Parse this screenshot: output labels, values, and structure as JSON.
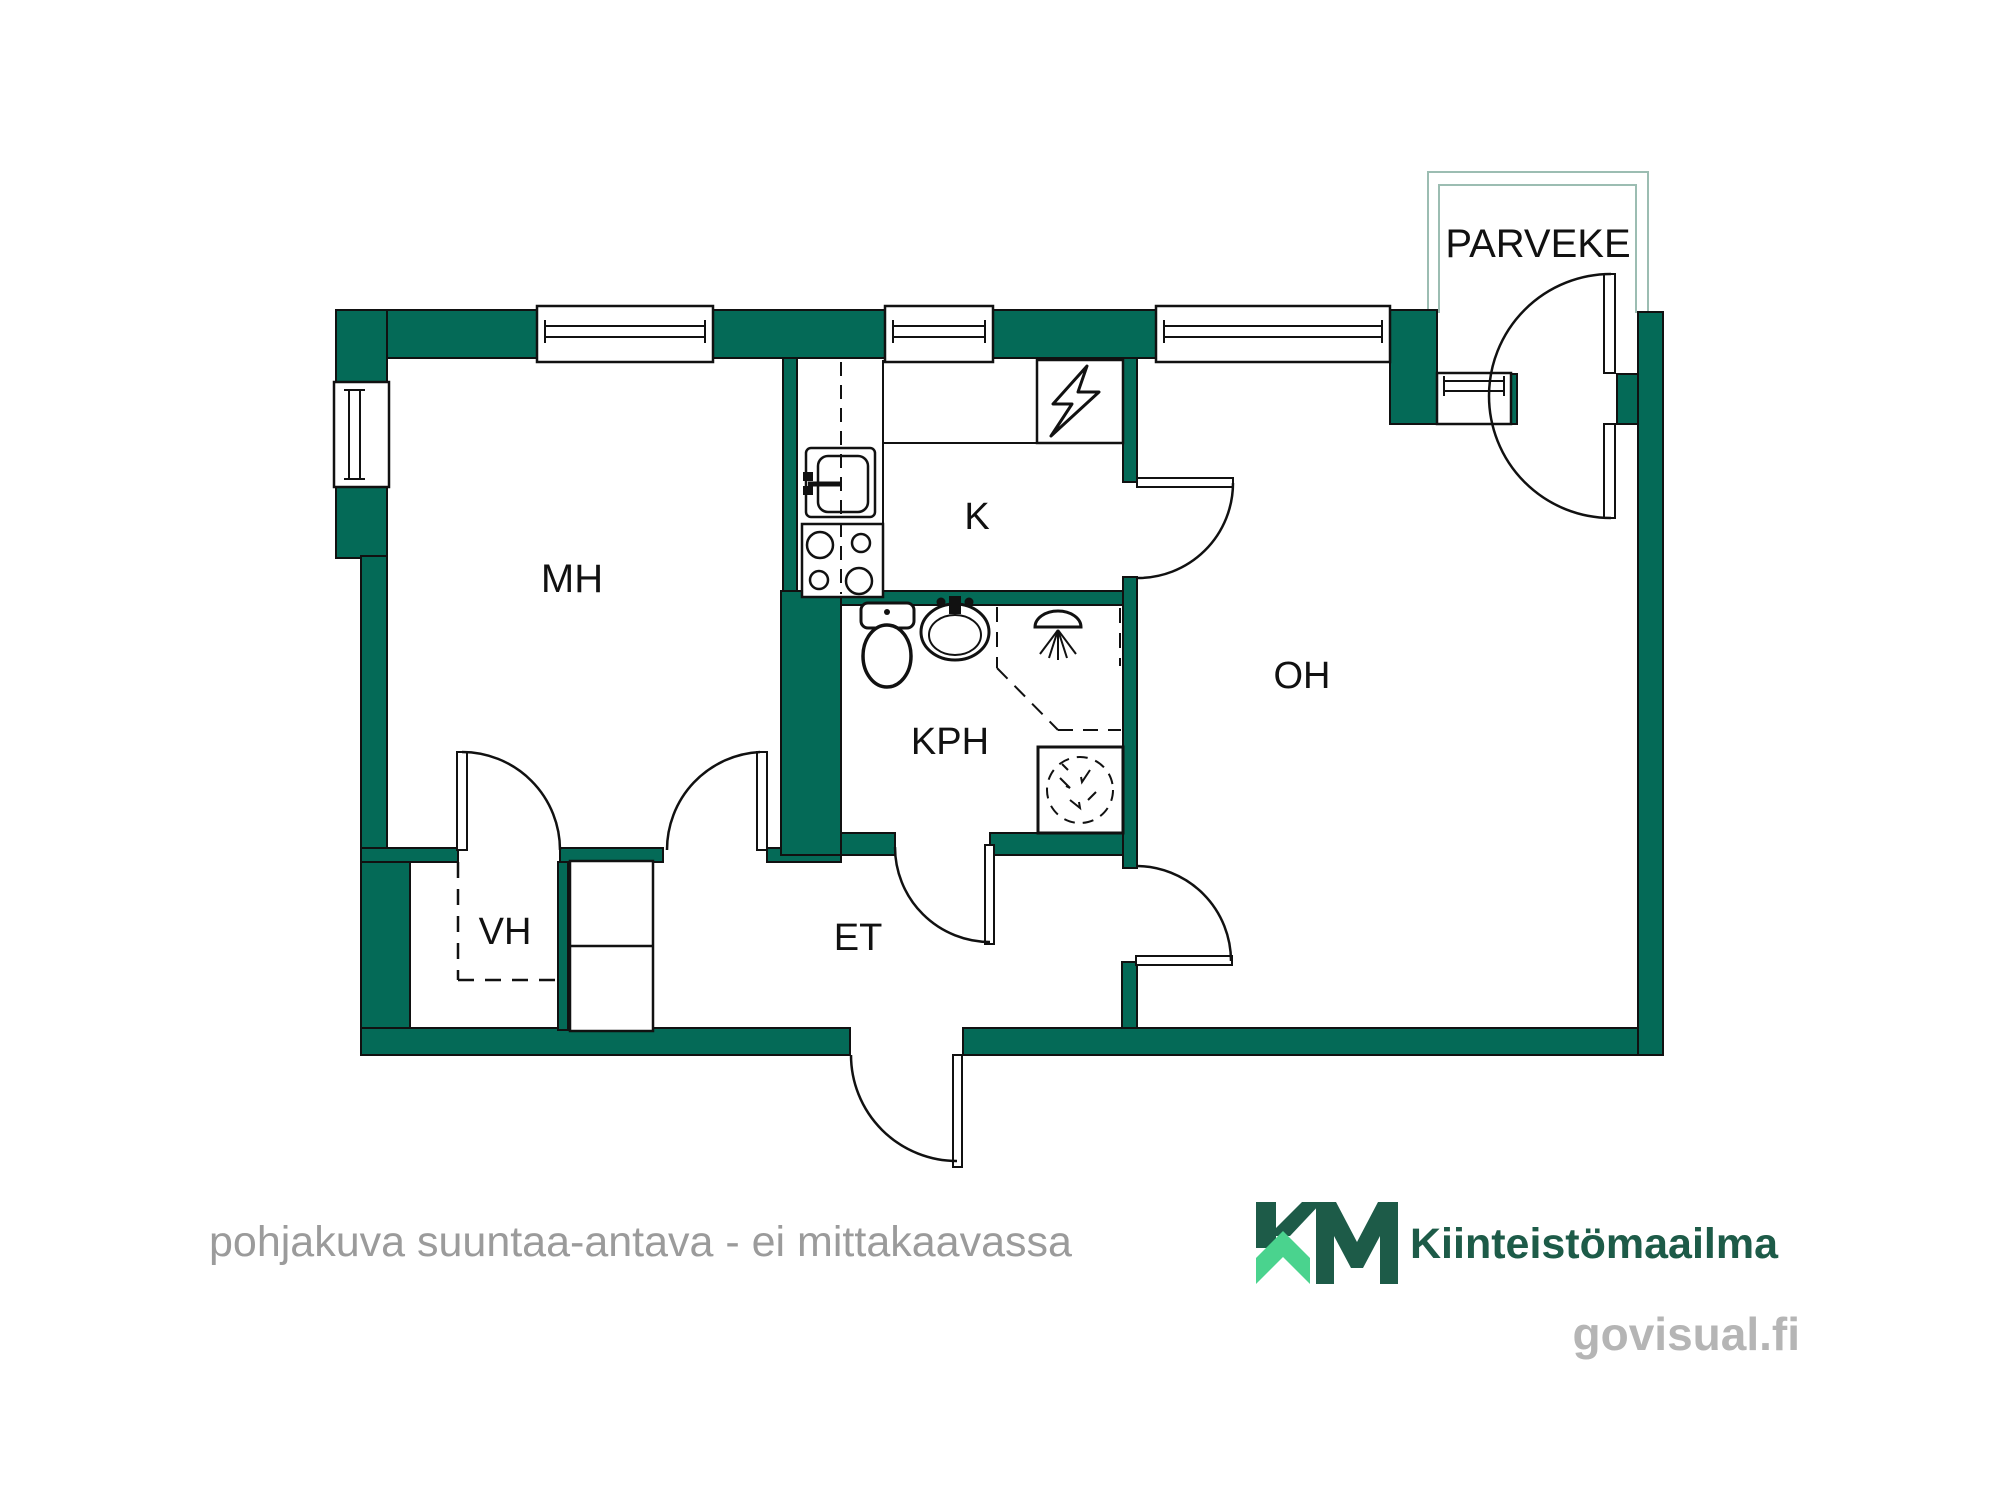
{
  "plan": {
    "type": "apartment floor plan",
    "rooms": {
      "bedroom": "MH",
      "kitchen": "K",
      "bathroom": "KPH",
      "living_room": "OH",
      "closet": "VH",
      "hallway": "ET",
      "balcony": "PARVEKE"
    },
    "watermark": "pohjakuva suuntaa-antava - ei mittakaavassa",
    "icons": [
      "toilet-icon",
      "bathroom-sink-icon",
      "shower-icon",
      "washing-machine-icon",
      "kitchen-sink-icon",
      "stove-icon",
      "electrical-panel-icon",
      "wardrobe",
      "door-swing",
      "window"
    ]
  },
  "branding": {
    "logo_monogram": "KM",
    "brand_name": "Kiinteistömaailma",
    "site": "govisual.fi"
  },
  "colors": {
    "wall": "#046a57",
    "line": "#111111",
    "balcony_outline": "#9cbdb2",
    "watermark": "#9b9b9b",
    "logo_dark": "#1d5b48",
    "logo_light": "#4ad38e",
    "site_gray": "#b5b5b5"
  }
}
